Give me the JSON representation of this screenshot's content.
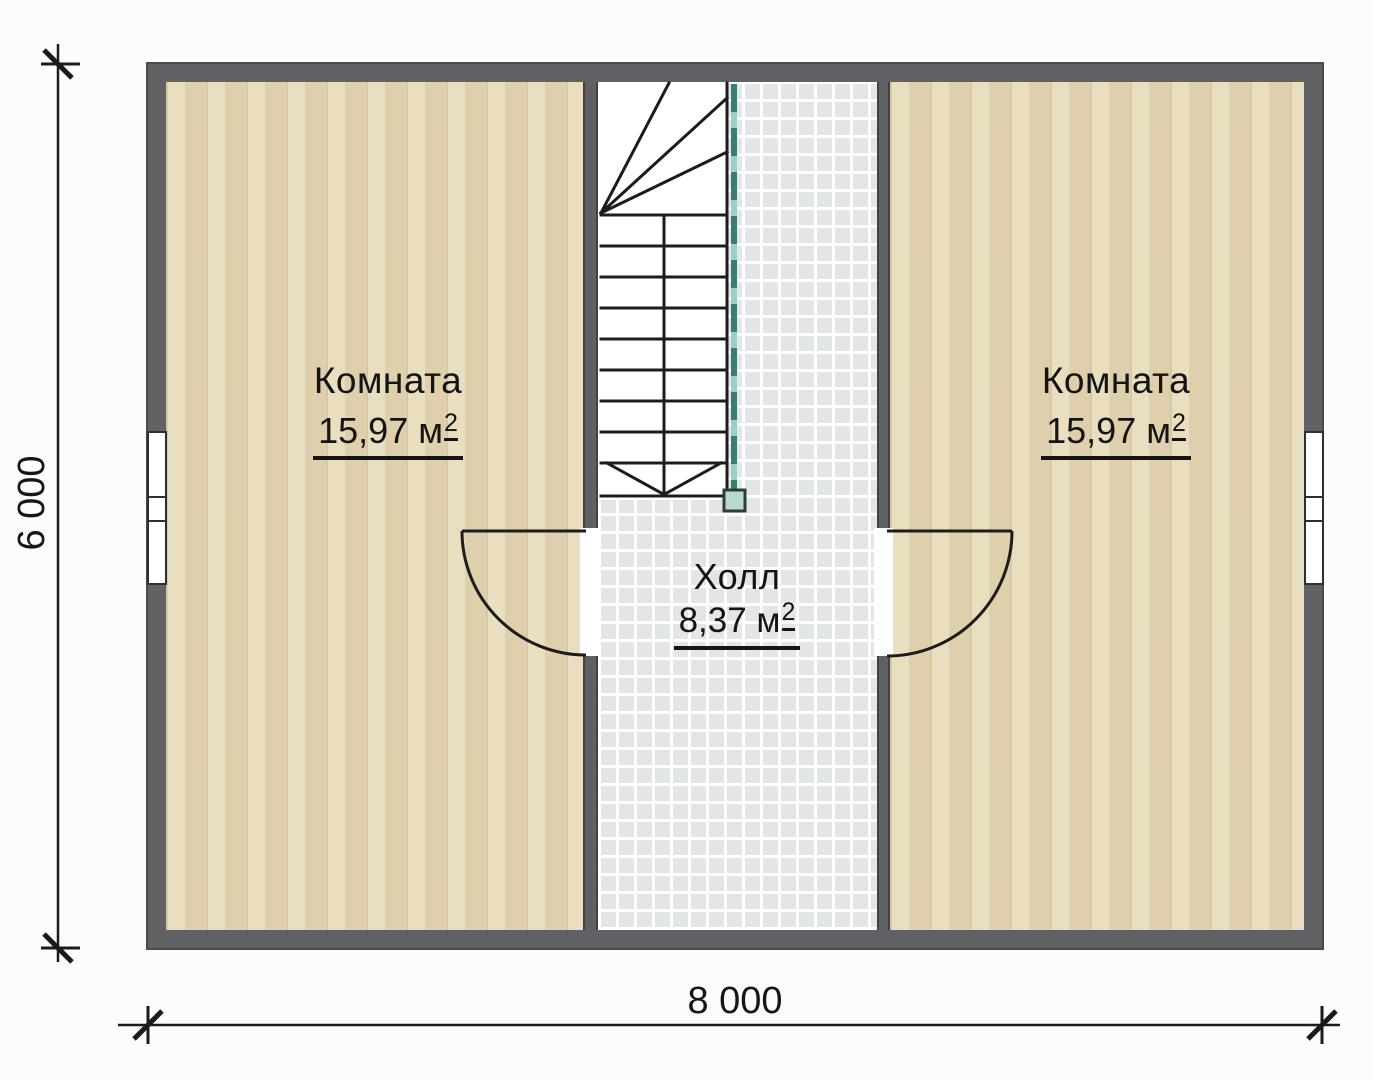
{
  "rooms": [
    {
      "name": "Комната",
      "area_value": "15,97 м",
      "area_exp": "2"
    },
    {
      "name": "Комната",
      "area_value": "15,97 м",
      "area_exp": "2"
    }
  ],
  "hall": {
    "name": "Холл",
    "area_value": "8,37 м",
    "area_exp": "2"
  },
  "dimensions": {
    "width": "8 000",
    "height": "6 000"
  },
  "colors": {
    "exterior_wall": "#5f6165",
    "wall_edge": "#404245",
    "wood_floor": "#e7d9b7",
    "tile_floor": "#e2e6e5",
    "stair_line": "#1c1c1c",
    "railing_teal": "#3a7d74",
    "railing_light": "#9ccfc7",
    "newel_fill": "#b9d8d2",
    "text": "#141414",
    "background": "#fcfcfc"
  }
}
